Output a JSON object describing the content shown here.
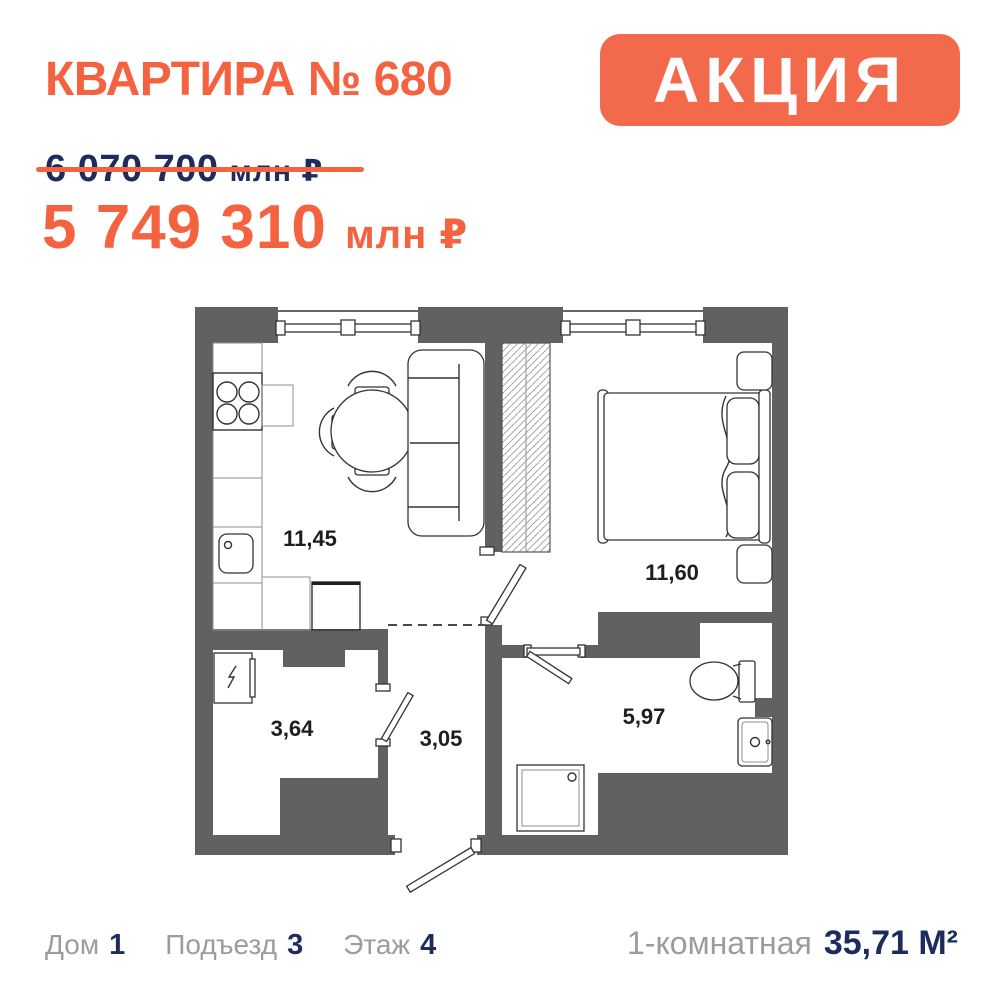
{
  "colors": {
    "accent_orange": "#F4623F",
    "badge_orange": "#F26A4B",
    "navy": "#1D2C5E",
    "label_gray": "#9C9C9C",
    "wall_gray": "#616161"
  },
  "header": {
    "title": "КВАРТИРА № 680",
    "badge": "АКЦИЯ"
  },
  "pricing": {
    "old_price": "6 070 700",
    "old_price_unit": "млн ₽",
    "new_price": "5 749 310",
    "new_price_unit": "млн ₽"
  },
  "plan": {
    "rooms": [
      {
        "id": "kitchen-living",
        "area": "11,45"
      },
      {
        "id": "bedroom",
        "area": "11,60"
      },
      {
        "id": "hallway",
        "area": "3,64"
      },
      {
        "id": "corridor",
        "area": "3,05"
      },
      {
        "id": "bathroom",
        "area": "5,97"
      }
    ]
  },
  "footer": {
    "items": [
      {
        "label": "Дом",
        "value": "1"
      },
      {
        "label": "Подъезд",
        "value": "3"
      },
      {
        "label": "Этаж",
        "value": "4"
      }
    ],
    "apartment_type": "1-комнатная",
    "total_area": "35,71 М²"
  }
}
